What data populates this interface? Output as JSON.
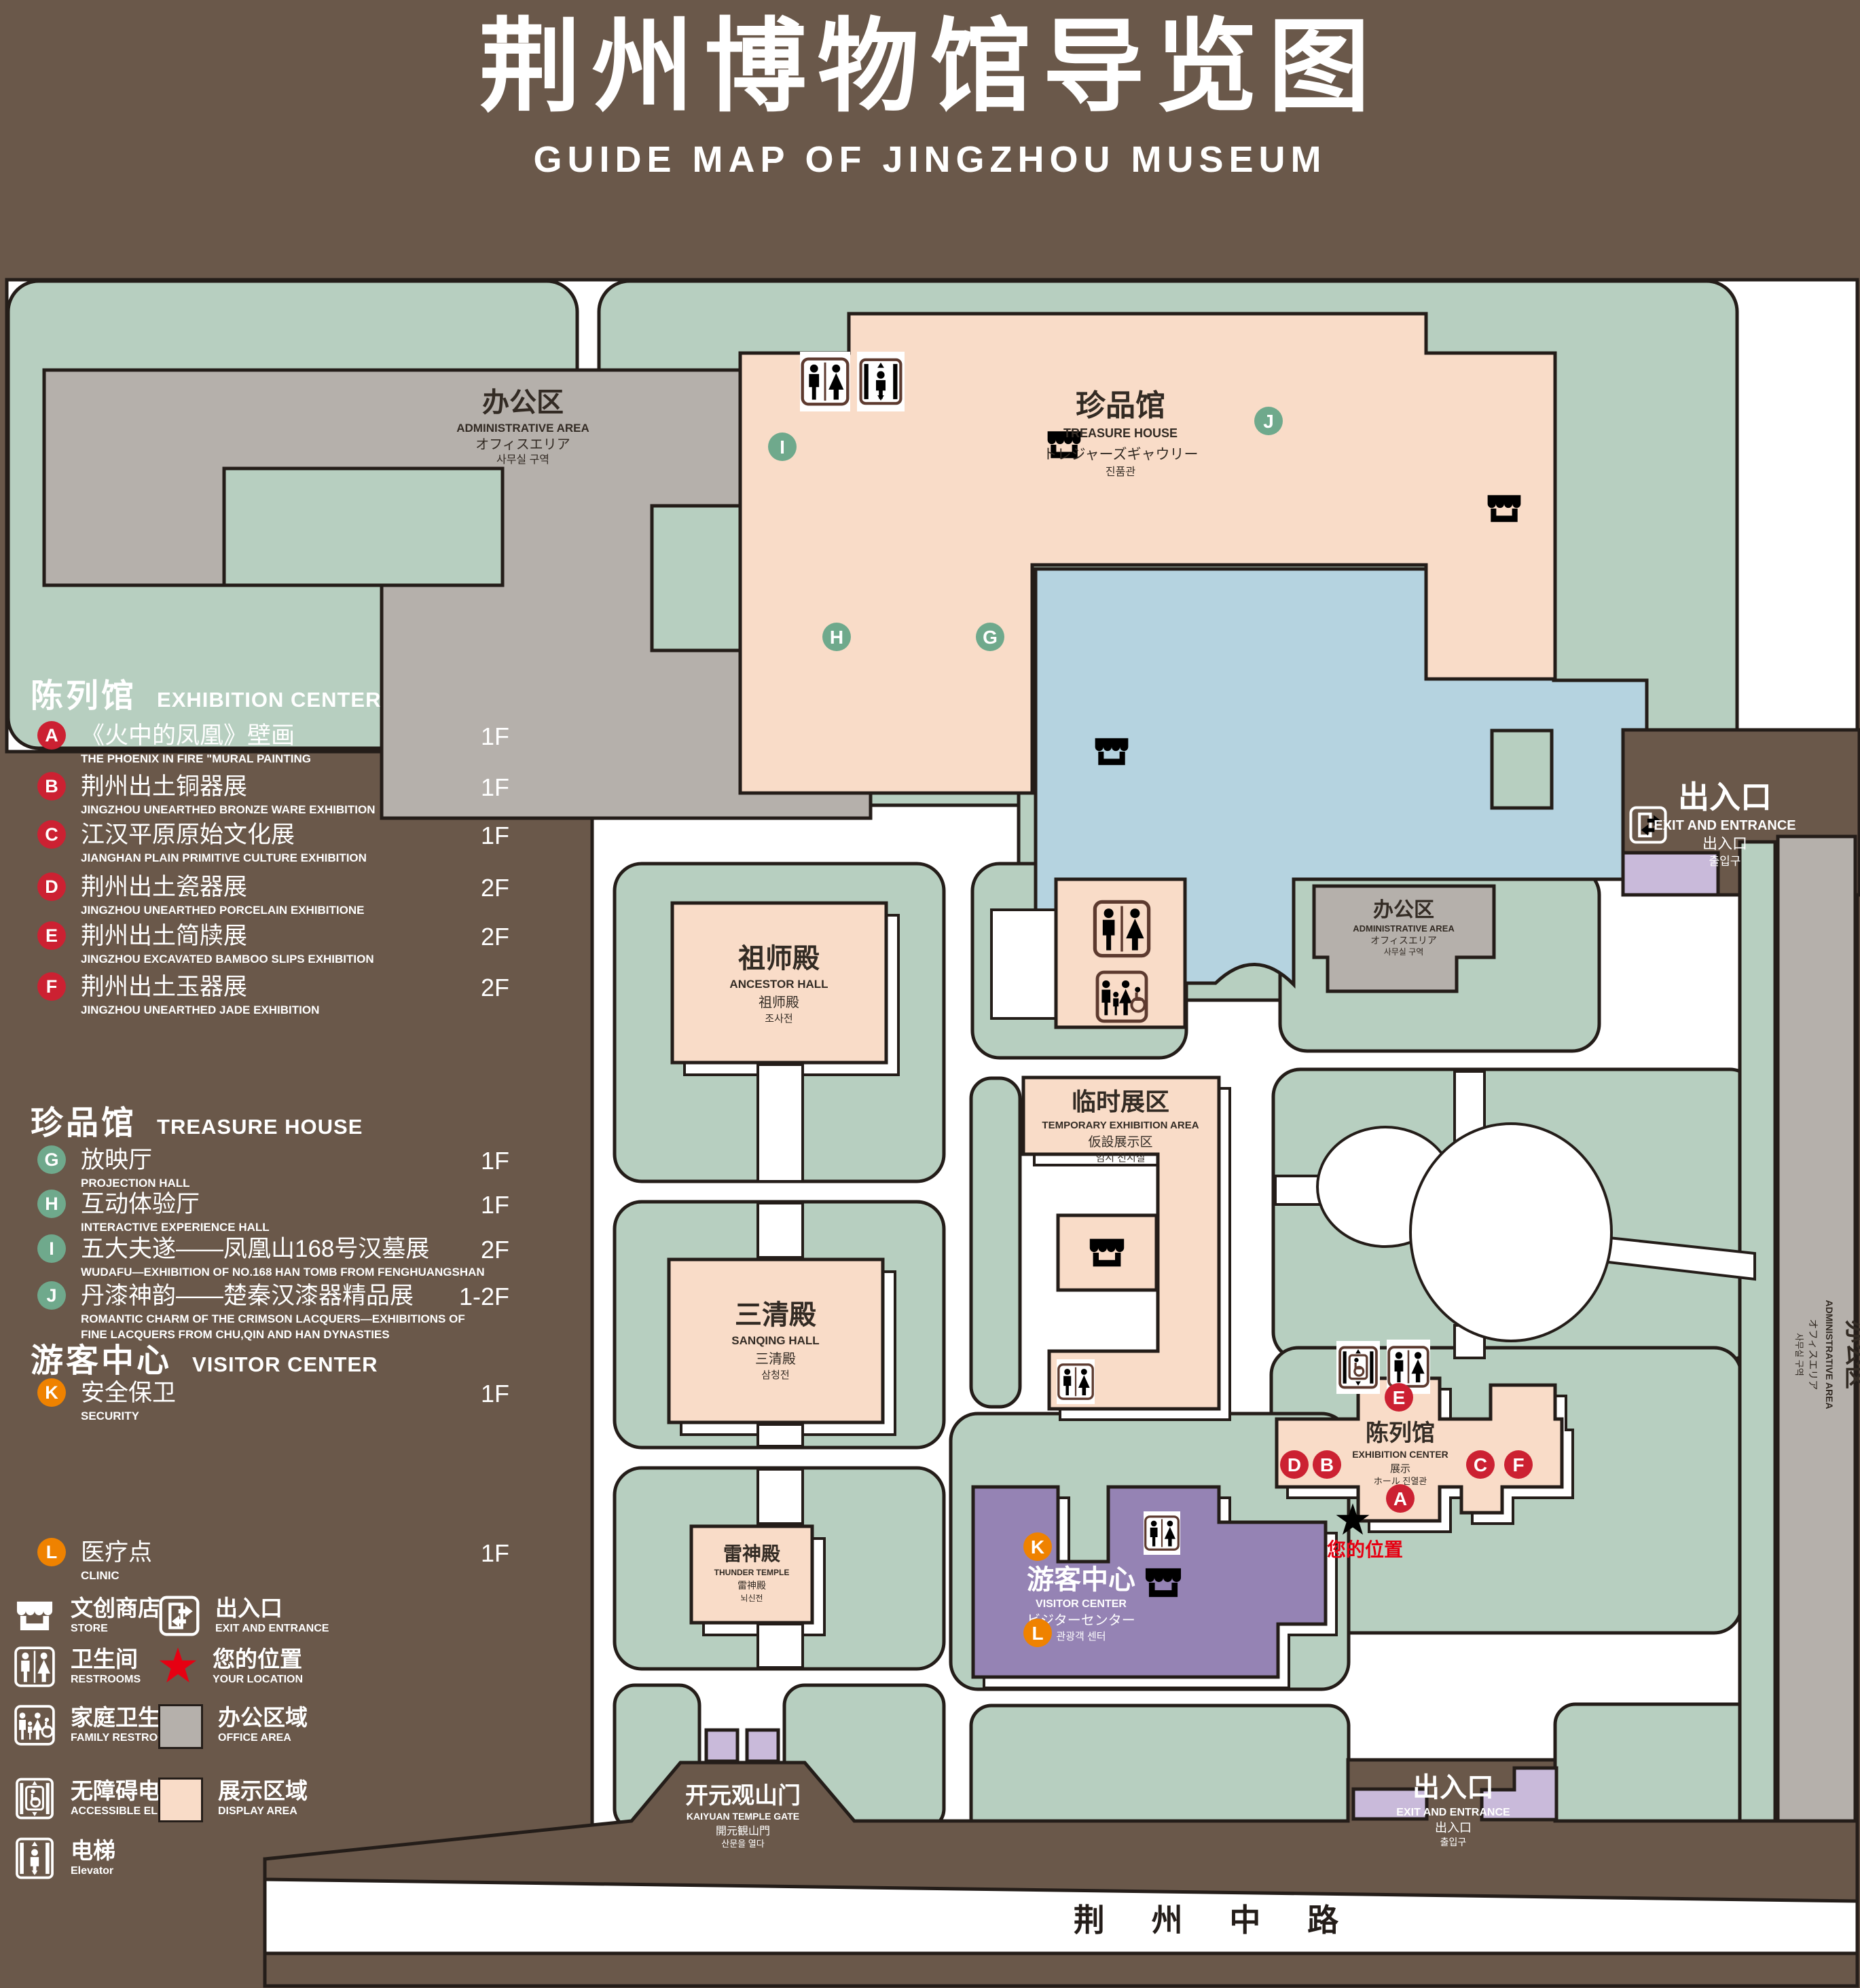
{
  "title": {
    "zh": "荆州博物馆导览图",
    "en": "GUIDE MAP OF JINGZHOU MUSEUM"
  },
  "colors": {
    "bg": "#6a584a",
    "green": "#b7cfc0",
    "gray": "#b5b0ab",
    "pink": "#f9dcc8",
    "blue": "#b5d3e0",
    "purple": "#9583b4",
    "light_purple": "#c9bada",
    "marker_red": "#cc2132",
    "marker_green": "#6fa98c",
    "marker_orange": "#ef8200",
    "accent_red": "#e60012",
    "icon_brown": "#5d3a2f"
  },
  "legend": {
    "sections": [
      {
        "zh": "陈列馆",
        "en": "EXHIBITION CENTER",
        "items": [
          {
            "letter": "A",
            "zh": "《火中的凤凰》壁画",
            "en": "THE PHOENIX IN FIRE \"MURAL PAINTING",
            "floor": "1F"
          },
          {
            "letter": "B",
            "zh": "荆州出土铜器展",
            "en": "JINGZHOU UNEARTHED BRONZE WARE EXHIBITION",
            "floor": "1F"
          },
          {
            "letter": "C",
            "zh": "江汉平原原始文化展",
            "en": "JIANGHAN PLAIN PRIMITIVE CULTURE EXHIBITION",
            "floor": "1F"
          },
          {
            "letter": "D",
            "zh": "荆州出土瓷器展",
            "en": "JINGZHOU UNEARTHED PORCELAIN EXHIBITIONE",
            "floor": "2F"
          },
          {
            "letter": "E",
            "zh": "荆州出土简牍展",
            "en": "JINGZHOU EXCAVATED BAMBOO SLIPS EXHIBITION",
            "floor": "2F"
          },
          {
            "letter": "F",
            "zh": "荆州出土玉器展",
            "en": "JINGZHOU UNEARTHED JADE EXHIBITION",
            "floor": "2F"
          }
        ]
      },
      {
        "zh": "珍品馆",
        "en": "TREASURE HOUSE",
        "items": [
          {
            "letter": "G",
            "zh": "放映厅",
            "en": "PROJECTION HALL",
            "floor": "1F"
          },
          {
            "letter": "H",
            "zh": "互动体验厅",
            "en": "INTERACTIVE EXPERIENCE HALL",
            "floor": "1F"
          },
          {
            "letter": "I",
            "zh": "五大夫遂——凤凰山168号汉墓展",
            "en": "WUDAFU—EXHIBITION OF NO.168 HAN TOMB FROM FENGHUANGSHAN",
            "floor": "2F"
          },
          {
            "letter": "J",
            "zh": "丹漆神韵——楚秦汉漆器精品展",
            "en": "ROMANTIC CHARM OF THE CRIMSON LACQUERS—EXHIBITIONS OF FINE LACQUERS FROM CHU,QIN AND HAN DYNASTIES",
            "floor": "1-2F"
          }
        ]
      },
      {
        "zh": "游客中心",
        "en": "VISITOR CENTER",
        "items": [
          {
            "letter": "K",
            "zh": "安全保卫",
            "en": "SECURITY",
            "floor": "1F"
          },
          {
            "letter": "L",
            "zh": "医疗点",
            "en": "CLINIC",
            "floor": "1F"
          }
        ]
      }
    ],
    "symbols_left": [
      {
        "zh": "文创商店",
        "en": "STORE"
      },
      {
        "zh": "卫生间",
        "en": "RESTROOMS"
      },
      {
        "zh": "家庭卫生间",
        "en": "FAMILY RESTROOMS"
      },
      {
        "zh": "无障碍电梯",
        "en": "ACCESSIBLE ELEVATOR"
      },
      {
        "zh": "电梯",
        "en": "Elevator"
      }
    ],
    "symbols_right": [
      {
        "zh": "出入口",
        "en": "EXIT AND ENTRANCE"
      },
      {
        "zh": "您的位置",
        "en": "YOUR LOCATION"
      },
      {
        "zh": "办公区域",
        "en": "OFFICE AREA"
      },
      {
        "zh": "展示区域",
        "en": "DISPLAY AREA"
      }
    ]
  },
  "map": {
    "road": "荆 州 中 路",
    "your_location": "您的位置",
    "labels": {
      "admin_tl": {
        "zh": "办公区",
        "en": "ADMINISTRATIVE AREA",
        "ja": "オフィスエリア",
        "ko": "사무실 구역"
      },
      "treasure": {
        "zh": "珍品馆",
        "en": "TREASURE HOUSE",
        "ja": "トレジャーズギャウリー",
        "ko": "진품관"
      },
      "exit_top": {
        "zh": "出入口",
        "en": "EXIT AND ENTRANCE",
        "zh2": "出入口",
        "ko": "출입구"
      },
      "admin_right": {
        "zh": "办公区",
        "en": "ADMINISTRATIVE AREA",
        "ja": "オフィスエリア",
        "ko": "사무실 구역"
      },
      "admin_strip": {
        "zh": "办公区",
        "en": "ADMINISTRATIVE AREA",
        "ja": "オフィスエリア",
        "ko": "사무실 구역"
      },
      "ancestor": {
        "zh": "祖师殿",
        "en": "ANCESTOR HALL",
        "ja": "祖师殿",
        "ko": "조사전"
      },
      "sanqing": {
        "zh": "三清殿",
        "en": "SANQING HALL",
        "ja": "三清殿",
        "ko": "삼청전"
      },
      "temp": {
        "zh": "临时展区",
        "en": "TEMPORARY EXHIBITION AREA",
        "ja": "仮設展示区",
        "ko": "임시 전시실"
      },
      "thunder": {
        "zh": "雷神殿",
        "en": "THUNDER TEMPLE",
        "ja": "雷神殿",
        "ko": "뇌신전"
      },
      "exhibition": {
        "zh": "陈列馆",
        "en": "EXHIBITION CENTER",
        "ja": "展示",
        "ko": "ホール 진열관"
      },
      "visitor": {
        "zh": "游客中心",
        "en": "VISITOR CENTER",
        "ja": "ビジターセンター",
        "ko": "관광객 센터"
      },
      "gate": {
        "zh": "开元观山门",
        "en": "KAIYUAN TEMPLE GATE",
        "ja": "開元観山門",
        "ko": "산문을 열다"
      },
      "exit_bottom": {
        "zh": "出入口",
        "en": "EXIT AND ENTRANCE",
        "zh2": "出入口",
        "ko": "출입구"
      }
    },
    "markers": {
      "a": "A",
      "b": "B",
      "c": "C",
      "d": "D",
      "e": "E",
      "f": "F",
      "g": "G",
      "h": "H",
      "i": "I",
      "j": "J",
      "k": "K",
      "l": "L"
    }
  }
}
